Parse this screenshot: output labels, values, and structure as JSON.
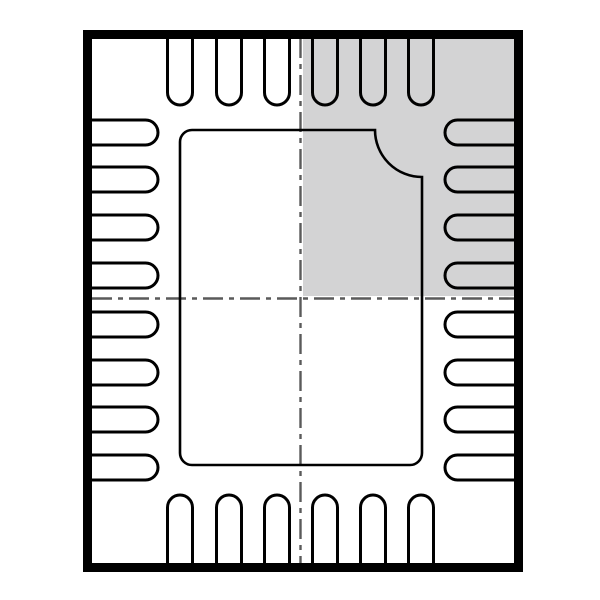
{
  "figure": {
    "kind": "ic-package-outline-top-view",
    "description": "QFN-style leadless package outline drawing with shaded pin-1 quadrant",
    "total_pins": 28,
    "colors": {
      "background": "#ffffff",
      "outline": "#000000",
      "shaded_quadrant": "#d3d3d4",
      "centerline_dash": "#5a5a5a",
      "centerline_casing": "#ffffff"
    },
    "canvas": {
      "width": 600,
      "height": 600
    },
    "body_outline": {
      "outer_left": 83,
      "outer_top": 30,
      "outer_right": 523,
      "outer_bottom": 572,
      "stroke_width": 9
    },
    "shaded_quadrant": {
      "position": "top-right",
      "x": 299,
      "y": 38,
      "width": 215,
      "height": 261
    },
    "centerlines": {
      "vertical_x": 300.5,
      "horizontal_y": 298.5,
      "top": 38,
      "bottom": 563,
      "left": 92,
      "right": 514,
      "dash_pattern": "20 6 5 6",
      "dash_width": 2.4,
      "casing_width": 5
    },
    "pins": {
      "stroke_width": 3,
      "half_width": 12.5,
      "top": {
        "count": 6,
        "centers_x": [
          180,
          229,
          277,
          325,
          373,
          421
        ],
        "base_y": 36,
        "tip_y": 105
      },
      "bottom": {
        "count": 6,
        "centers_x": [
          180,
          229,
          277,
          325,
          373,
          421
        ],
        "base_y": 566,
        "tip_y": 495
      },
      "left": {
        "count": 8,
        "centers_y": [
          132.5,
          179.5,
          227.5,
          275.5,
          324.5,
          372.5,
          419.5,
          467.5
        ],
        "base_x": 90,
        "tip_x": 158
      },
      "right": {
        "count": 8,
        "centers_y": [
          132.5,
          179.5,
          227.5,
          275.5,
          324.5,
          372.5,
          419.5,
          467.5
        ],
        "base_x": 516,
        "tip_x": 445
      }
    },
    "exposed_pad": {
      "x": 180,
      "y": 130,
      "width": 242,
      "height": 335,
      "corner_radius": 12,
      "stroke_width": 2.6,
      "chamfer": {
        "corner": "top-right",
        "radius": 47,
        "style": "concave-arc"
      }
    }
  }
}
